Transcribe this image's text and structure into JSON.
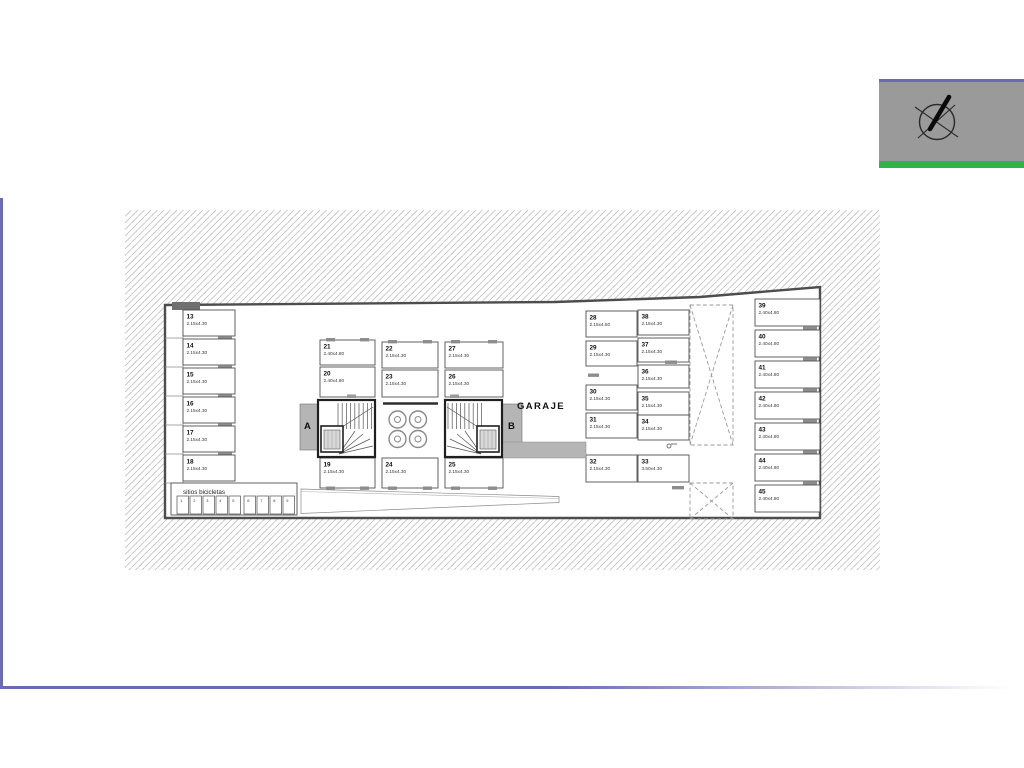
{
  "page": {
    "background": "#ffffff",
    "accent_color": "#6b6bb5"
  },
  "compass_block": {
    "panel_color": "#9a9a9a",
    "top_line_color": "#6b6bb5",
    "green_stripe_color": "#2fb44a",
    "icon": "compass-north-arrow"
  },
  "plan": {
    "garage_label": "GARAJE",
    "bike_area_label": "sitios bicicletas",
    "bike_slots": [
      "1",
      "2",
      "3",
      "4",
      "5",
      "6",
      "7",
      "8",
      "9"
    ],
    "core_a_label": "A",
    "core_b_label": "B",
    "spaces_left_column": [
      {
        "num": "13",
        "dim": "2.15x4.30"
      },
      {
        "num": "14",
        "dim": "2.15x4.30"
      },
      {
        "num": "15",
        "dim": "2.15x4.30"
      },
      {
        "num": "16",
        "dim": "2.15x4.30"
      },
      {
        "num": "17",
        "dim": "2.15x4.30"
      },
      {
        "num": "18",
        "dim": "2.15x4.30"
      }
    ],
    "storage_rooms": [
      {
        "num": "21",
        "dim": "2.40x4.80"
      },
      {
        "num": "20",
        "dim": "2.40x4.80"
      },
      {
        "num": "19",
        "dim": "2.15x4.30"
      },
      {
        "num": "22",
        "dim": "2.15x4.30"
      },
      {
        "num": "23",
        "dim": "2.15x4.30"
      },
      {
        "num": "24",
        "dim": "2.15x4.30"
      },
      {
        "num": "27",
        "dim": "2.15x4.30"
      },
      {
        "num": "26",
        "dim": "2.15x4.30"
      },
      {
        "num": "25",
        "dim": "2.15x4.30"
      }
    ],
    "garage_inner_column": [
      {
        "num": "28",
        "dim": "2.15x4.50"
      },
      {
        "num": "29",
        "dim": "2.15x4.30"
      },
      {
        "num": "30",
        "dim": "2.15x4.30"
      },
      {
        "num": "31",
        "dim": "2.15x4.30"
      },
      {
        "num": "32",
        "dim": "2.15x4.30"
      }
    ],
    "garage_outer_column": [
      {
        "num": "38",
        "dim": "2.15x4.30"
      },
      {
        "num": "37",
        "dim": "2.15x4.30"
      },
      {
        "num": "36",
        "dim": "2.15x4.30"
      },
      {
        "num": "35",
        "dim": "2.15x4.30"
      },
      {
        "num": "34",
        "dim": "2.15x4.30"
      },
      {
        "num": "33",
        "dim": "3.50x4.30"
      }
    ],
    "spaces_right_column": [
      {
        "num": "39",
        "dim": "2.40x4.80"
      },
      {
        "num": "40",
        "dim": "2.40x4.80"
      },
      {
        "num": "41",
        "dim": "2.40x4.80"
      },
      {
        "num": "42",
        "dim": "2.40x4.80"
      },
      {
        "num": "43",
        "dim": "2.40x4.80"
      },
      {
        "num": "44",
        "dim": "2.40x4.80"
      },
      {
        "num": "45",
        "dim": "2.40x4.80"
      }
    ]
  }
}
